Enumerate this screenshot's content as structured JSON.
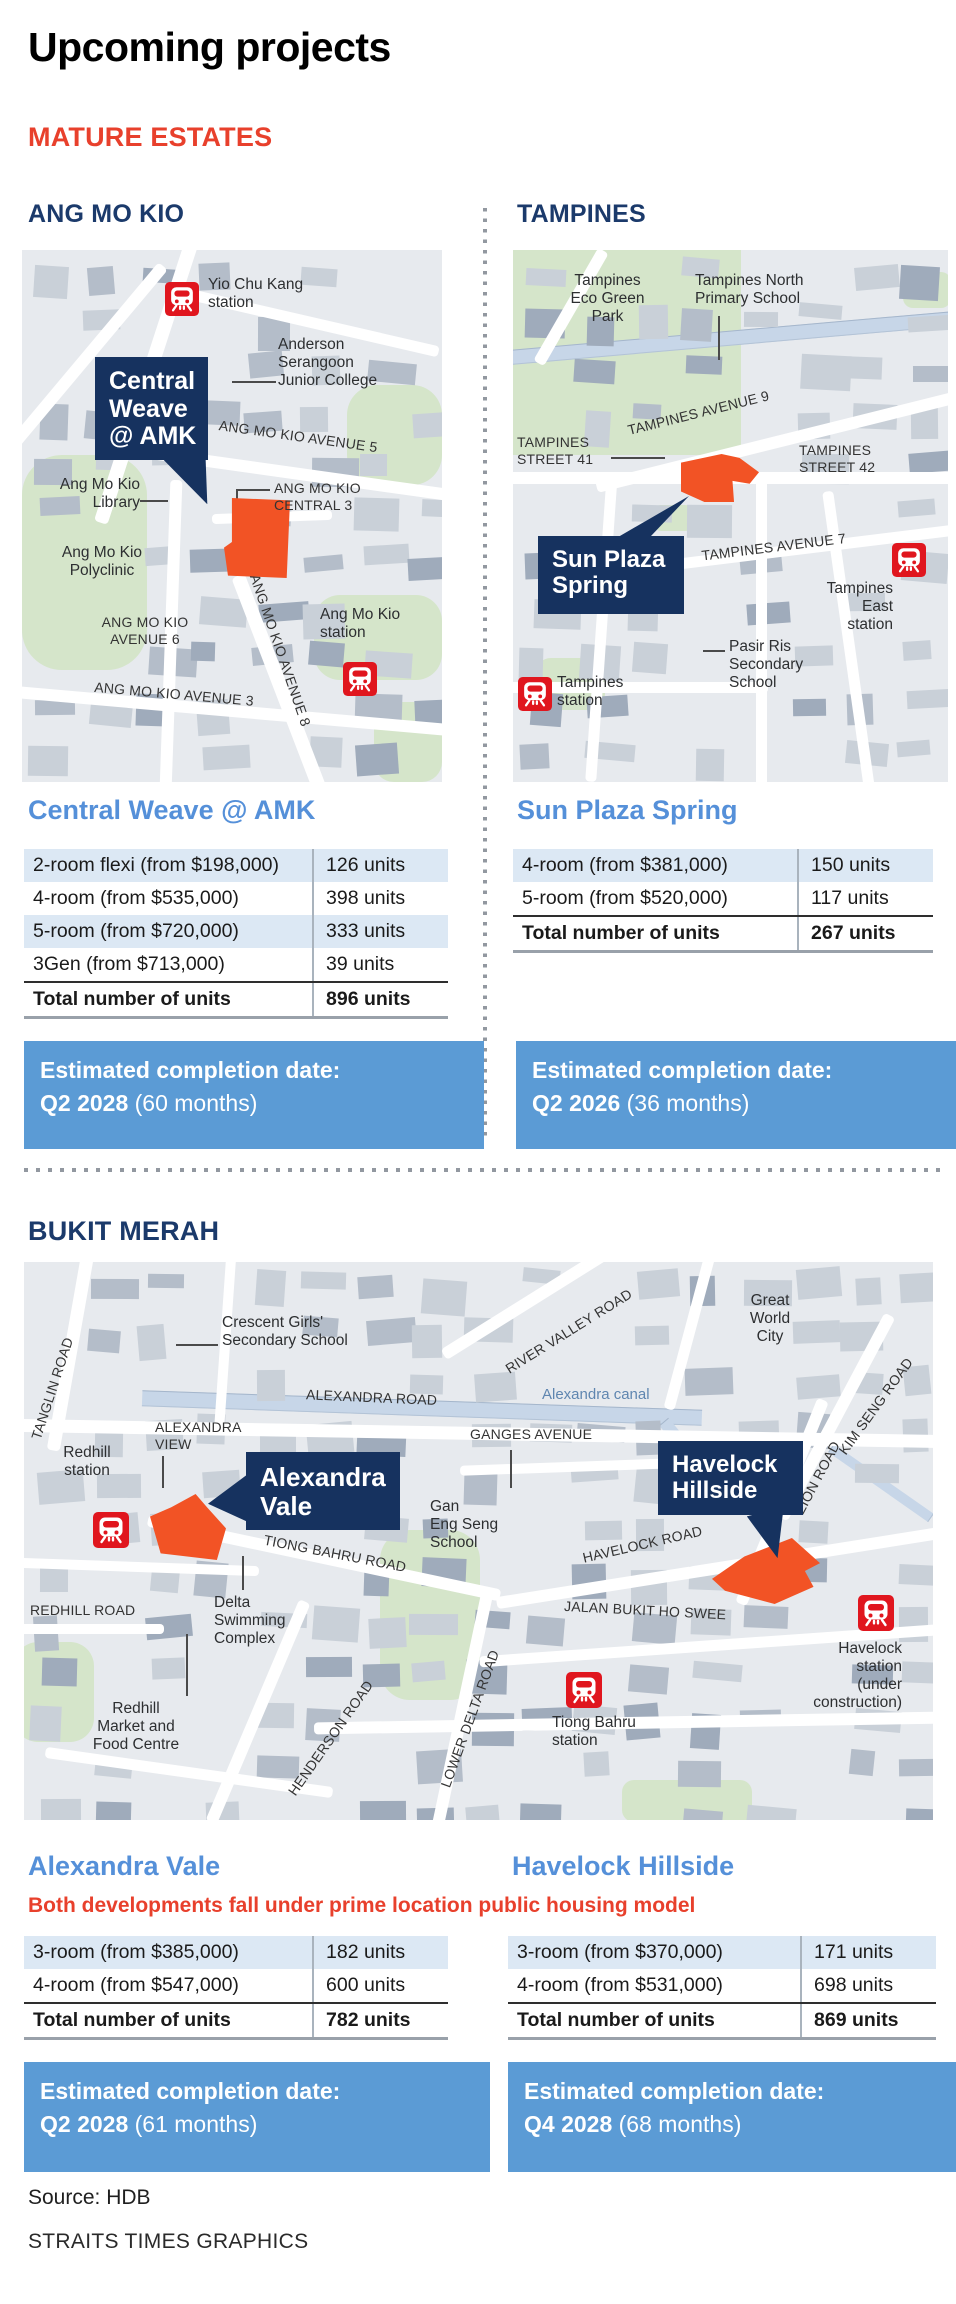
{
  "page": {
    "title": "Upcoming projects",
    "category": "MATURE ESTATES",
    "source": "Source: HDB",
    "credit": "STRAITS TIMES GRAPHICS"
  },
  "colors": {
    "navy_heading": "#1b3a6b",
    "callout_navy": "#16325f",
    "accent_red": "#e8402c",
    "site_orange": "#f25325",
    "mrt_red": "#e0161e",
    "project_blue": "#5590d9",
    "banner_blue": "#5b9bd5",
    "row_shade": "#dce8f4"
  },
  "top": {
    "left": {
      "estate_heading": "ANG MO KIO",
      "map": {
        "callout": "Central\nWeave\n@ AMK",
        "labels": [
          {
            "text": "Yio Chu Kang\nstation",
            "x": 186,
            "y": 26,
            "cls": "place"
          },
          {
            "text": "Anderson\nSerangoon\nJunior College",
            "x": 256,
            "y": 86,
            "cls": "place"
          },
          {
            "text": "ANG MO KIO AVENUE 5",
            "x": 196,
            "y": 182,
            "cls": "road-lbl",
            "rot": 8,
            "w": 215
          },
          {
            "text": "ANG MO KIO\nCENTRAL 3",
            "x": 252,
            "y": 230,
            "cls": "road-lbl"
          },
          {
            "text": "Ang Mo Kio\nLibrary",
            "x": 26,
            "y": 226,
            "cls": "place",
            "align": "right",
            "w": 92
          },
          {
            "text": "Ang Mo Kio\nPolyclinic",
            "x": 24,
            "y": 294,
            "cls": "place",
            "align": "center",
            "w": 112
          },
          {
            "text": "ANG MO KIO\nAVENUE 6",
            "x": 64,
            "y": 364,
            "cls": "road-lbl",
            "align": "center",
            "w": 118
          },
          {
            "text": "ANG MO KIO AVENUE 3",
            "x": 72,
            "y": 438,
            "cls": "road-lbl",
            "rot": 5,
            "w": 210
          },
          {
            "text": "ANG MO KIO AVENUE 8",
            "x": 240,
            "y": 322,
            "cls": "road-lbl",
            "rot": 71,
            "w": 210,
            "origin": "0 0"
          },
          {
            "text": "Ang Mo Kio\nstation",
            "x": 298,
            "y": 356,
            "cls": "place"
          }
        ],
        "icons": [
          {
            "name": "mrt-station-icon",
            "x": 143,
            "y": 32,
            "s": 34
          },
          {
            "name": "mrt-station-icon",
            "x": 321,
            "y": 412,
            "s": 34
          }
        ]
      },
      "project": {
        "name": "Central Weave @ AMK",
        "rows": [
          {
            "label": "2-room flexi (from $198,000)",
            "value": "126 units"
          },
          {
            "label": "4-room (from $535,000)",
            "value": "398 units"
          },
          {
            "label": "5-room (from $720,000)",
            "value": "333 units"
          },
          {
            "label": "3Gen (from $713,000)",
            "value": "39 units"
          }
        ],
        "total_label": "Total number of units",
        "total_value": "896 units",
        "completion": {
          "label": "Estimated completion date:",
          "date": "Q2 2028",
          "note": "(60 months)"
        }
      }
    },
    "right": {
      "estate_heading": "TAMPINES",
      "map": {
        "callout": "Sun Plaza\nSpring",
        "labels": [
          {
            "text": "Tampines\nEco Green\nPark",
            "x": 42,
            "y": 22,
            "cls": "place",
            "align": "center",
            "w": 105
          },
          {
            "text": "Tampines North\nPrimary School",
            "x": 182,
            "y": 22,
            "cls": "place"
          },
          {
            "text": "TAMPINES AVENUE 9",
            "x": 112,
            "y": 148,
            "cls": "road-lbl",
            "rot": -14,
            "w": 200
          },
          {
            "text": "TAMPINES\nSTREET 41",
            "x": 4,
            "y": 184,
            "cls": "road-lbl"
          },
          {
            "text": "TAMPINES\nSTREET 42",
            "x": 286,
            "y": 192,
            "cls": "road-lbl"
          },
          {
            "text": "TAMPINES AVENUE 7",
            "x": 188,
            "y": 286,
            "cls": "road-lbl",
            "rot": -7,
            "w": 190
          },
          {
            "text": "Tampines\nEast\nstation",
            "x": 292,
            "y": 330,
            "cls": "place",
            "align": "right",
            "w": 88
          },
          {
            "text": "Pasir Ris\nSecondary\nSchool",
            "x": 216,
            "y": 388,
            "cls": "place"
          },
          {
            "text": "Tampines\nstation",
            "x": 44,
            "y": 424,
            "cls": "place"
          }
        ],
        "icons": [
          {
            "name": "mrt-station-icon",
            "x": 379,
            "y": 293,
            "s": 34
          },
          {
            "name": "mrt-station-icon",
            "x": 5,
            "y": 427,
            "s": 34
          }
        ]
      },
      "project": {
        "name": "Sun Plaza Spring",
        "rows": [
          {
            "label": "4-room (from $381,000)",
            "value": "150 units"
          },
          {
            "label": "5-room (from $520,000)",
            "value": "117 units"
          }
        ],
        "total_label": "Total number of units",
        "total_value": "267 units",
        "completion": {
          "label": "Estimated completion date:",
          "date": "Q2 2026",
          "note": "(36 months)"
        }
      }
    }
  },
  "bukit_merah": {
    "estate_heading": "BUKIT MERAH",
    "note": "Both developments fall under prime location public housing model",
    "map": {
      "callout_av": "Alexandra\nVale",
      "callout_hh": "Havelock\nHillside",
      "labels": [
        {
          "text": "TANGLIN ROAD",
          "x": -33,
          "y": 107,
          "cls": "road-lbl",
          "rot": -72,
          "w": 130
        },
        {
          "text": "Crescent Girls'\nSecondary School",
          "x": 198,
          "y": 52,
          "cls": "place"
        },
        {
          "text": "ALEXANDRA ROAD",
          "x": 282,
          "y": 128,
          "cls": "road-lbl",
          "rot": 2.5,
          "w": 170
        },
        {
          "text": "Alexandra canal",
          "x": 518,
          "y": 124,
          "cls": "canal-lbl"
        },
        {
          "text": "ALEXANDRA\nVIEW",
          "x": 131,
          "y": 157,
          "cls": "road-lbl"
        },
        {
          "text": "Redhill\nstation",
          "x": 22,
          "y": 182,
          "cls": "place",
          "align": "center",
          "w": 82
        },
        {
          "text": "RIVER VALLEY ROAD",
          "x": 468,
          "y": 48,
          "cls": "road-lbl",
          "rot": -32,
          "w": 195
        },
        {
          "text": "Great\nWorld\nCity",
          "x": 710,
          "y": 30,
          "cls": "place",
          "align": "center",
          "w": 72
        },
        {
          "text": "KIM SENG ROAD",
          "x": 788,
          "y": 124,
          "cls": "road-lbl",
          "rot": -54,
          "w": 145
        },
        {
          "text": "ZION ROAD",
          "x": 747,
          "y": 196,
          "cls": "road-lbl",
          "rot": -62,
          "w": 105
        },
        {
          "text": "GANGES AVENUE",
          "x": 446,
          "y": 164,
          "cls": "road-lbl",
          "w": 160
        },
        {
          "text": "HAVELOCK  ROAD",
          "x": 556,
          "y": 262,
          "cls": "road-lbl",
          "rot": -13,
          "w": 230
        },
        {
          "text": "JALAN BUKIT HO SWEE",
          "x": 540,
          "y": 342,
          "cls": "road-lbl",
          "rot": 3,
          "w": 235
        },
        {
          "text": "TIONG BAHRU ROAD",
          "x": 238,
          "y": 290,
          "cls": "road-lbl",
          "rot": 11,
          "w": 215
        },
        {
          "text": "Gan\nEng Seng\nSchool",
          "x": 406,
          "y": 236,
          "cls": "place"
        },
        {
          "text": "REDHILL ROAD",
          "x": 6,
          "y": 340,
          "cls": "road-lbl",
          "w": 150
        },
        {
          "text": "Delta\nSwimming\nComplex",
          "x": 190,
          "y": 332,
          "cls": "place"
        },
        {
          "text": "HENDERSON ROAD",
          "x": 228,
          "y": 448,
          "cls": "road-lbl",
          "rot": -55,
          "w": 185
        },
        {
          "text": "Redhill\nMarket and\nFood Centre",
          "x": 52,
          "y": 438,
          "cls": "place",
          "align": "center",
          "w": 120
        },
        {
          "text": "LOWER DELTA ROAD",
          "x": 362,
          "y": 432,
          "cls": "road-lbl",
          "rot": -70,
          "w": 180
        },
        {
          "text": "Havelock\nstation\n(under\nconstruction)",
          "x": 748,
          "y": 378,
          "cls": "place",
          "align": "right",
          "w": 130
        },
        {
          "text": "Tiong Bahru\nstation",
          "x": 528,
          "y": 452,
          "cls": "place"
        }
      ],
      "icons": [
        {
          "name": "mrt-station-icon",
          "x": 69,
          "y": 250,
          "s": 36
        },
        {
          "name": "mrt-station-icon",
          "x": 542,
          "y": 410,
          "s": 36
        },
        {
          "name": "mrt-station-icon",
          "x": 834,
          "y": 333,
          "s": 36
        }
      ]
    },
    "left_project": {
      "name": "Alexandra Vale",
      "rows": [
        {
          "label": "3-room (from $385,000)",
          "value": "182 units"
        },
        {
          "label": "4-room (from $547,000)",
          "value": "600 units"
        }
      ],
      "total_label": "Total number of units",
      "total_value": "782 units",
      "completion": {
        "label": "Estimated completion date:",
        "date": "Q2 2028",
        "note": "(61 months)"
      }
    },
    "right_project": {
      "name": "Havelock Hillside",
      "rows": [
        {
          "label": "3-room (from $370,000)",
          "value": "171 units"
        },
        {
          "label": "4-room (from $531,000)",
          "value": "698 units"
        }
      ],
      "total_label": "Total number of units",
      "total_value": "869 units",
      "completion": {
        "label": "Estimated completion date:",
        "date": "Q4 2028",
        "note": "(68 months)"
      }
    }
  }
}
